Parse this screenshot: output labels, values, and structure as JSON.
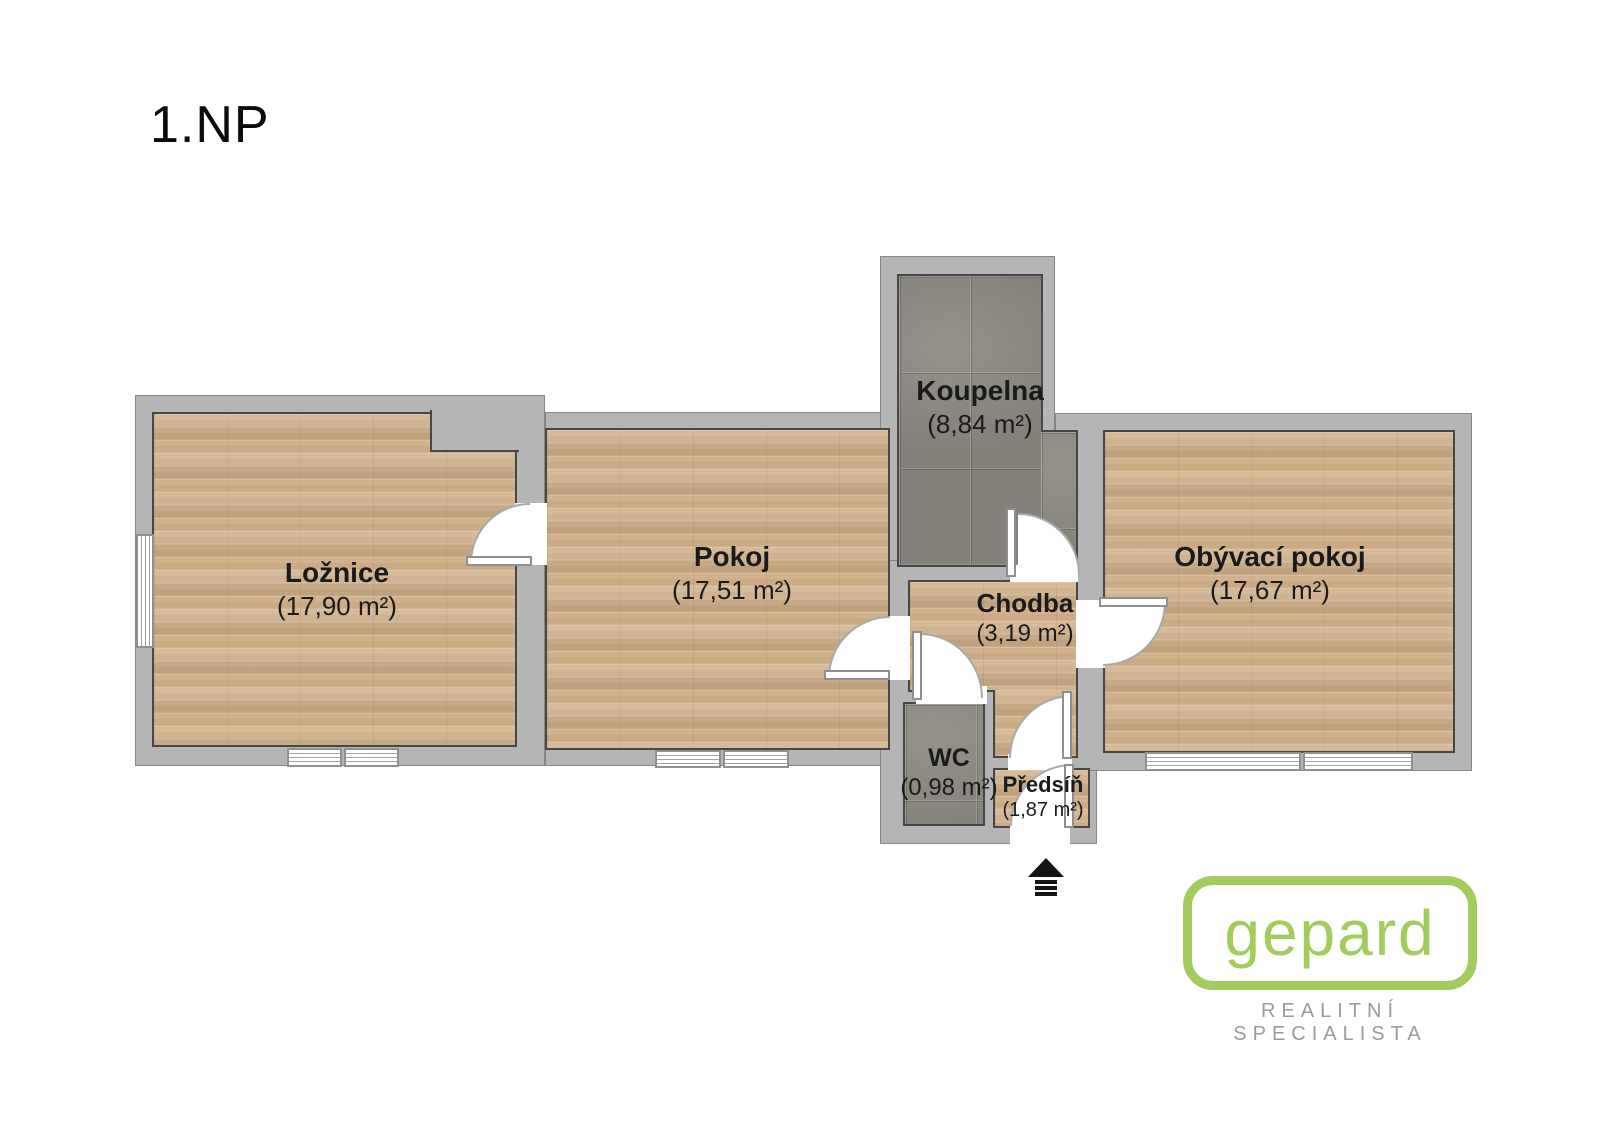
{
  "title": "1.NP",
  "rooms": [
    {
      "key": "loznice",
      "name": "Ložnice",
      "area": "(17,90 m²)",
      "floor": "wood"
    },
    {
      "key": "pokoj",
      "name": "Pokoj",
      "area": "(17,51 m²)",
      "floor": "wood"
    },
    {
      "key": "koupelna",
      "name": "Koupelna",
      "area": "(8,84 m²)",
      "floor": "tile"
    },
    {
      "key": "chodba",
      "name": "Chodba",
      "area": "(3,19 m²)",
      "floor": "wood"
    },
    {
      "key": "obyvaci-pokoj",
      "name": "Obývací pokoj",
      "area": "(17,67 m²)",
      "floor": "wood"
    },
    {
      "key": "wc",
      "name": "WC",
      "area": "(0,98 m²)",
      "floor": "tile"
    },
    {
      "key": "predsin",
      "name": "Předsíň",
      "area": "(1,87 m²)",
      "floor": "wood"
    }
  ],
  "logo": {
    "brand": "gepard",
    "tagline": "REALITNÍ SPECIALISTA"
  },
  "entrance": {
    "marker": "entrance-arrow"
  },
  "colors": {
    "wall": "#b5b5b5",
    "wood": "#d2b28d",
    "tile": "#8e8b83",
    "outline": "#474747",
    "label": "#1a1a1a",
    "logo-green": "#a3cb5d",
    "tagline-gray": "#9b9b9b"
  }
}
